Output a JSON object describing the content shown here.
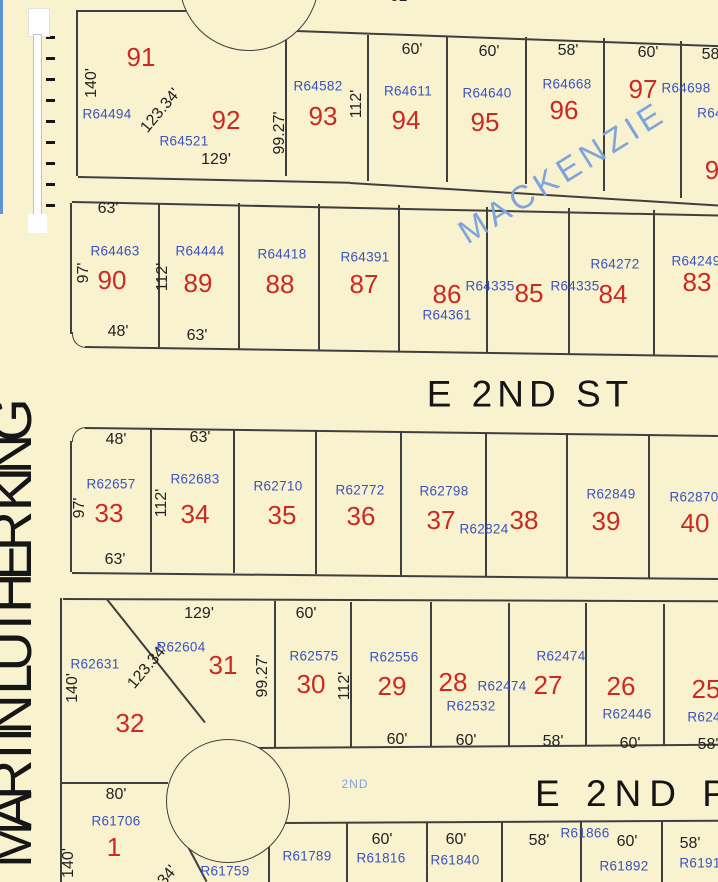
{
  "map": {
    "colors": {
      "background_cream": "#F9F2CF",
      "lot_number_red": "#CB2A22",
      "parcel_id_blue": "#3952C1",
      "dimension_dark": "#222222",
      "street_light_blue": "#7FA4DC",
      "boundary_line": "#3f3f3f"
    },
    "streets": {
      "mlk": "MARTIN LUTHER KING",
      "e_2nd_st": "E 2ND ST",
      "mackenzie": "MACKENZIE",
      "e_2nd_partial": "E 2ND P",
      "second_small": "2ND"
    },
    "labels": [
      {
        "text": "61'",
        "x": 400,
        "y": -3,
        "t": "dim"
      },
      {
        "text": "91",
        "x": 141,
        "y": 57,
        "t": "lot"
      },
      {
        "text": "140'",
        "x": 92,
        "y": 83,
        "r": -90,
        "t": "dim"
      },
      {
        "text": "R64494",
        "x": 107,
        "y": 114,
        "t": "rid"
      },
      {
        "text": "123.34'",
        "x": 161,
        "y": 111,
        "r": -50,
        "t": "dim"
      },
      {
        "text": "92",
        "x": 226,
        "y": 120,
        "t": "lot"
      },
      {
        "text": "R64521",
        "x": 184,
        "y": 141,
        "t": "rid"
      },
      {
        "text": "129'",
        "x": 216,
        "y": 160,
        "t": "dim"
      },
      {
        "text": "99.27'",
        "x": 280,
        "y": 133,
        "r": -90,
        "t": "dim"
      },
      {
        "text": "R64582",
        "x": 318,
        "y": 86,
        "t": "rid"
      },
      {
        "text": "93",
        "x": 323,
        "y": 116,
        "t": "lot"
      },
      {
        "text": "112'",
        "x": 357,
        "y": 104,
        "r": -90,
        "t": "dim"
      },
      {
        "text": "60'",
        "x": 412,
        "y": 50,
        "t": "dim"
      },
      {
        "text": "R64611",
        "x": 408,
        "y": 91,
        "t": "rid"
      },
      {
        "text": "94",
        "x": 406,
        "y": 120,
        "t": "lot"
      },
      {
        "text": "60'",
        "x": 489,
        "y": 52,
        "t": "dim"
      },
      {
        "text": "R64640",
        "x": 487,
        "y": 93,
        "t": "rid"
      },
      {
        "text": "95",
        "x": 485,
        "y": 122,
        "t": "lot"
      },
      {
        "text": "58'",
        "x": 568,
        "y": 51,
        "t": "dim"
      },
      {
        "text": "R64668",
        "x": 567,
        "y": 84,
        "t": "rid"
      },
      {
        "text": "96",
        "x": 564,
        "y": 110,
        "t": "lot"
      },
      {
        "text": "60'",
        "x": 648,
        "y": 53,
        "t": "dim"
      },
      {
        "text": "97",
        "x": 643,
        "y": 89,
        "t": "lot"
      },
      {
        "text": "R64698",
        "x": 686,
        "y": 88,
        "t": "rid"
      },
      {
        "text": "58'",
        "x": 712,
        "y": 55,
        "t": "dim"
      },
      {
        "text": "R64",
        "x": 710,
        "y": 113,
        "t": "rid"
      },
      {
        "text": "9",
        "x": 712,
        "y": 170,
        "t": "lot"
      },
      {
        "text": "63'",
        "x": 108,
        "y": 209,
        "t": "dim"
      },
      {
        "text": "R64463",
        "x": 115,
        "y": 251,
        "t": "rid"
      },
      {
        "text": "97'",
        "x": 84,
        "y": 273,
        "r": -90,
        "t": "dim"
      },
      {
        "text": "90",
        "x": 112,
        "y": 280,
        "t": "lot"
      },
      {
        "text": "48'",
        "x": 118,
        "y": 332,
        "t": "dim"
      },
      {
        "text": "112'",
        "x": 163,
        "y": 277,
        "r": -90,
        "t": "dim"
      },
      {
        "text": "R64444",
        "x": 200,
        "y": 251,
        "t": "rid"
      },
      {
        "text": "89",
        "x": 198,
        "y": 283,
        "t": "lot"
      },
      {
        "text": "63'",
        "x": 197,
        "y": 336,
        "t": "dim"
      },
      {
        "text": "R64418",
        "x": 282,
        "y": 254,
        "t": "rid"
      },
      {
        "text": "88",
        "x": 280,
        "y": 284,
        "t": "lot"
      },
      {
        "text": "R64391",
        "x": 365,
        "y": 257,
        "t": "rid"
      },
      {
        "text": "87",
        "x": 364,
        "y": 284,
        "t": "lot"
      },
      {
        "text": "86",
        "x": 447,
        "y": 294,
        "t": "lot"
      },
      {
        "text": "R64335",
        "x": 490,
        "y": 286,
        "t": "rid"
      },
      {
        "text": "R64361",
        "x": 447,
        "y": 315,
        "t": "rid"
      },
      {
        "text": "85",
        "x": 529,
        "y": 293,
        "t": "lot"
      },
      {
        "text": "R64335",
        "x": 575,
        "y": 286,
        "t": "rid"
      },
      {
        "text": "84",
        "x": 613,
        "y": 294,
        "t": "lot"
      },
      {
        "text": "R64272",
        "x": 615,
        "y": 264,
        "t": "rid"
      },
      {
        "text": "83",
        "x": 697,
        "y": 282,
        "t": "lot"
      },
      {
        "text": "R64249",
        "x": 696,
        "y": 261,
        "t": "rid"
      },
      {
        "text": "48'",
        "x": 116,
        "y": 440,
        "t": "dim"
      },
      {
        "text": "R62657",
        "x": 111,
        "y": 484,
        "t": "rid"
      },
      {
        "text": "97'",
        "x": 80,
        "y": 508,
        "r": -90,
        "t": "dim"
      },
      {
        "text": "33",
        "x": 109,
        "y": 513,
        "t": "lot"
      },
      {
        "text": "63'",
        "x": 115,
        "y": 560,
        "t": "dim"
      },
      {
        "text": "63'",
        "x": 200,
        "y": 438,
        "t": "dim"
      },
      {
        "text": "R62683",
        "x": 195,
        "y": 479,
        "t": "rid"
      },
      {
        "text": "112'",
        "x": 162,
        "y": 503,
        "r": -90,
        "t": "dim"
      },
      {
        "text": "34",
        "x": 195,
        "y": 514,
        "t": "lot"
      },
      {
        "text": "R62710",
        "x": 278,
        "y": 486,
        "t": "rid"
      },
      {
        "text": "35",
        "x": 282,
        "y": 515,
        "t": "lot"
      },
      {
        "text": "R62772",
        "x": 360,
        "y": 490,
        "t": "rid"
      },
      {
        "text": "36",
        "x": 361,
        "y": 516,
        "t": "lot"
      },
      {
        "text": "R62798",
        "x": 444,
        "y": 491,
        "t": "rid"
      },
      {
        "text": "37",
        "x": 441,
        "y": 520,
        "t": "lot"
      },
      {
        "text": "R62824",
        "x": 484,
        "y": 529,
        "t": "rid"
      },
      {
        "text": "38",
        "x": 524,
        "y": 520,
        "t": "lot"
      },
      {
        "text": "R62849",
        "x": 611,
        "y": 494,
        "t": "rid"
      },
      {
        "text": "39",
        "x": 606,
        "y": 521,
        "t": "lot"
      },
      {
        "text": "R62870",
        "x": 694,
        "y": 497,
        "t": "rid"
      },
      {
        "text": "40",
        "x": 695,
        "y": 523,
        "t": "lot"
      },
      {
        "text": "R62631",
        "x": 95,
        "y": 664,
        "t": "rid"
      },
      {
        "text": "140'",
        "x": 73,
        "y": 688,
        "r": -90,
        "t": "dim"
      },
      {
        "text": "32",
        "x": 130,
        "y": 723,
        "t": "lot"
      },
      {
        "text": "123.34'",
        "x": 148,
        "y": 667,
        "r": -50,
        "t": "dim"
      },
      {
        "text": "129'",
        "x": 199,
        "y": 614,
        "t": "dim"
      },
      {
        "text": "R62604",
        "x": 181,
        "y": 647,
        "t": "rid"
      },
      {
        "text": "31",
        "x": 223,
        "y": 665,
        "t": "lot"
      },
      {
        "text": "99.27'",
        "x": 263,
        "y": 676,
        "r": -90,
        "t": "dim"
      },
      {
        "text": "60'",
        "x": 306,
        "y": 614,
        "t": "dim"
      },
      {
        "text": "R62575",
        "x": 314,
        "y": 656,
        "t": "rid"
      },
      {
        "text": "30",
        "x": 311,
        "y": 684,
        "t": "lot"
      },
      {
        "text": "112'",
        "x": 345,
        "y": 686,
        "r": -90,
        "t": "dim"
      },
      {
        "text": "R62556",
        "x": 394,
        "y": 657,
        "t": "rid"
      },
      {
        "text": "29",
        "x": 392,
        "y": 686,
        "t": "lot"
      },
      {
        "text": "60'",
        "x": 397,
        "y": 740,
        "t": "dim"
      },
      {
        "text": "28",
        "x": 453,
        "y": 682,
        "t": "lot"
      },
      {
        "text": "R62474",
        "x": 502,
        "y": 686,
        "t": "rid"
      },
      {
        "text": "R62532",
        "x": 471,
        "y": 706,
        "t": "rid"
      },
      {
        "text": "60'",
        "x": 466,
        "y": 741,
        "t": "dim"
      },
      {
        "text": "R62474",
        "x": 561,
        "y": 656,
        "t": "rid"
      },
      {
        "text": "27",
        "x": 548,
        "y": 685,
        "t": "lot"
      },
      {
        "text": "58'",
        "x": 553,
        "y": 742,
        "t": "dim"
      },
      {
        "text": "26",
        "x": 621,
        "y": 686,
        "t": "lot"
      },
      {
        "text": "R62446",
        "x": 627,
        "y": 714,
        "t": "rid"
      },
      {
        "text": "60'",
        "x": 630,
        "y": 744,
        "t": "dim"
      },
      {
        "text": "25",
        "x": 706,
        "y": 689,
        "t": "lot"
      },
      {
        "text": "R6241",
        "x": 708,
        "y": 717,
        "t": "rid"
      },
      {
        "text": "58'",
        "x": 708,
        "y": 745,
        "t": "dim"
      },
      {
        "text": "80'",
        "x": 116,
        "y": 795,
        "t": "dim"
      },
      {
        "text": "R61706",
        "x": 116,
        "y": 821,
        "t": "rid"
      },
      {
        "text": "1",
        "x": 114,
        "y": 847,
        "t": "lot"
      },
      {
        "text": "140'",
        "x": 69,
        "y": 863,
        "r": -90,
        "t": "dim"
      },
      {
        "text": "123.34'",
        "x": 158,
        "y": 888,
        "r": -50,
        "t": "dim"
      },
      {
        "text": "R61759",
        "x": 225,
        "y": 871,
        "t": "rid"
      },
      {
        "text": "R61789",
        "x": 307,
        "y": 856,
        "t": "rid"
      },
      {
        "text": "60'",
        "x": 382,
        "y": 840,
        "t": "dim"
      },
      {
        "text": "R61816",
        "x": 381,
        "y": 858,
        "t": "rid"
      },
      {
        "text": "60'",
        "x": 456,
        "y": 840,
        "t": "dim"
      },
      {
        "text": "R61840",
        "x": 455,
        "y": 860,
        "t": "rid"
      },
      {
        "text": "58'",
        "x": 539,
        "y": 841,
        "t": "dim"
      },
      {
        "text": "R61866",
        "x": 585,
        "y": 833,
        "t": "rid"
      },
      {
        "text": "60'",
        "x": 627,
        "y": 842,
        "t": "dim"
      },
      {
        "text": "R61892",
        "x": 624,
        "y": 866,
        "t": "rid"
      },
      {
        "text": "58'",
        "x": 690,
        "y": 844,
        "t": "dim"
      },
      {
        "text": "R6191",
        "x": 700,
        "y": 863,
        "t": "rid"
      }
    ]
  }
}
